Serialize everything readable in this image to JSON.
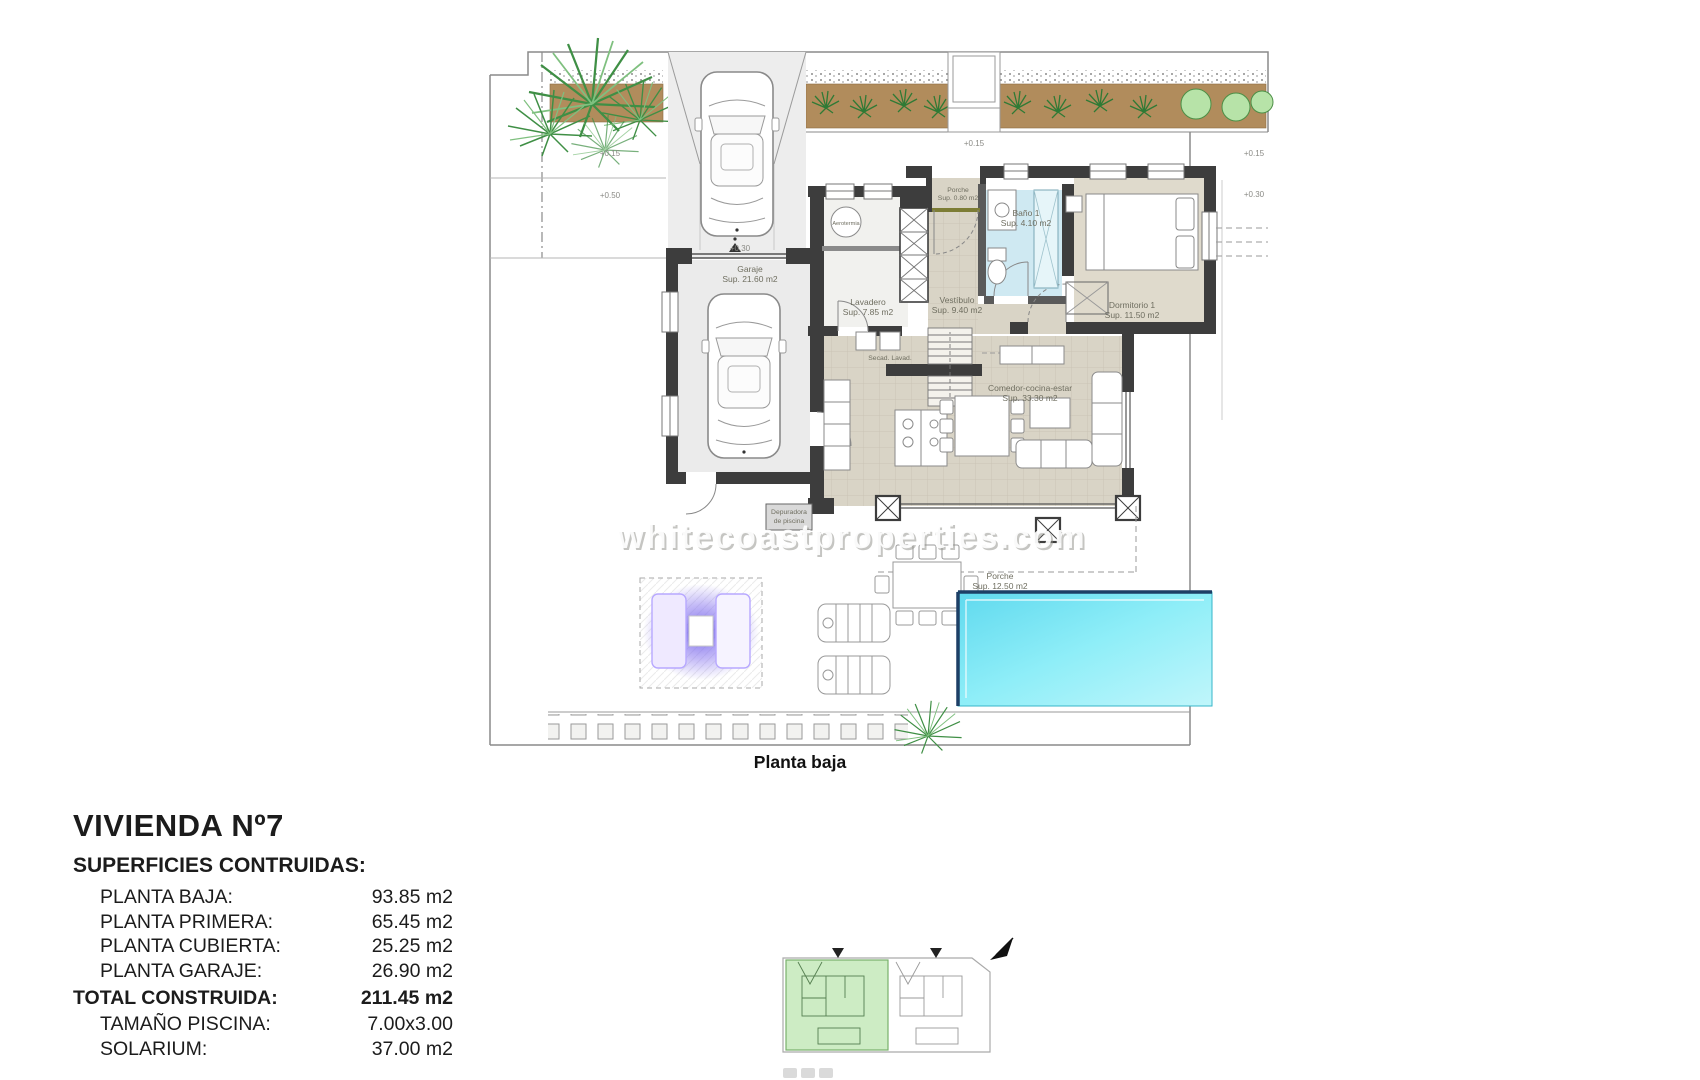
{
  "document": {
    "caption": "Planta baja",
    "watermark": "whitecoastproperties.com"
  },
  "summary": {
    "title": "VIVIENDA Nº7",
    "subtitle": "SUPERFICIES CONTRUIDAS:",
    "rows": [
      {
        "label": "PLANTA BAJA:",
        "value": "93.85 m2"
      },
      {
        "label": "PLANTA PRIMERA:",
        "value": "65.45 m2"
      },
      {
        "label": "PLANTA CUBIERTA:",
        "value": "25.25 m2"
      },
      {
        "label": "PLANTA GARAJE:",
        "value": "26.90 m2"
      }
    ],
    "total": {
      "label": "TOTAL CONSTRUIDA:",
      "value": "211.45 m2"
    },
    "extras": [
      {
        "label": "TAMAÑO PISCINA:",
        "value": "7.00x3.00"
      },
      {
        "label": "SOLARIUM:",
        "value": "37.00 m2"
      }
    ]
  },
  "plan": {
    "rooms": {
      "garaje": {
        "name": "Garaje",
        "area": "Sup. 21.60 m2"
      },
      "lavadero": {
        "name": "Lavadero",
        "area": "Sup. 7.85 m2"
      },
      "vestibulo": {
        "name": "Vestíbulo",
        "area": "Sup. 9.40 m2"
      },
      "bano1": {
        "name": "Baño 1",
        "area": "Sup. 4.10 m2"
      },
      "dormitorio1": {
        "name": "Dormitorio 1",
        "area": "Sup. 11.50 m2"
      },
      "comedor": {
        "name": "Comedor-cocina-estar",
        "area": "Sup. 33.30 m2"
      },
      "porche_entrada": {
        "name": "Porche",
        "area": "Sup. 0.80 m2"
      },
      "porche_terraza": {
        "name": "Porche",
        "area": "Sup. 12.50 m2"
      }
    },
    "equipment": {
      "aerotermia": "Aerotermia",
      "depuradora_l1": "Depuradora",
      "depuradora_l2": "de piscina",
      "secadora_lavadora": "Secad. Lavad."
    },
    "levels": {
      "front_1": "+0.15",
      "front_2": "+0.50",
      "driveway": "+0.30",
      "walkway": "+0.15",
      "right_1": "+0.15",
      "right_2": "+0.30"
    },
    "colors": {
      "wall": "#3d3d3d",
      "floor_beige": "#d9d4c6",
      "bath_blue": "#cfe9f2",
      "pool_cyan": "#7ce8f6",
      "pool_edge": "#1d3f66",
      "soil_brown": "#b18c5c",
      "plant_green": "#3f8f45",
      "highlight_green": "#cdecc4",
      "lounge_purple": "#6c5ce7"
    }
  }
}
